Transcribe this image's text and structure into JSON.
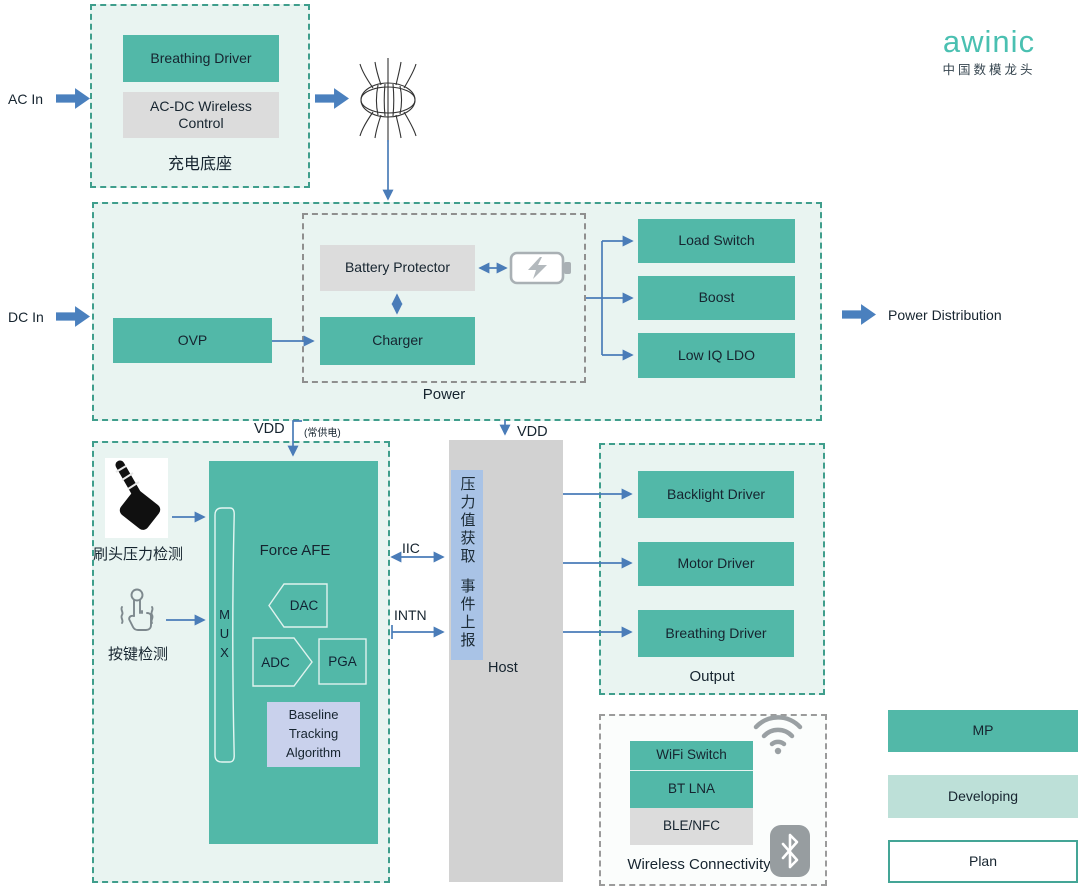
{
  "brand": {
    "logo_text": "awinic",
    "tagline": "中国数模龙头",
    "logo_color": "#4ac0b1"
  },
  "colors": {
    "block_teal": "#52b8a8",
    "block_gray": "#dcdcdc",
    "box_bg": "#e9f4f1",
    "box_border_teal": "#3f9e8c",
    "arrow_blue": "#4a7cb8",
    "fat_arrow_blue": "#4a80be",
    "host_gray": "#d2d2d2",
    "host_strip_blue": "#a9c3e6",
    "baseline_lavender": "#c9d1ec",
    "developing_teal": "#bde0d8"
  },
  "io_labels": {
    "ac_in": "AC In",
    "dc_in": "DC In",
    "power_distribution": "Power Distribution"
  },
  "signal_labels": {
    "vdd_left": "VDD",
    "vdd_left_note": "(常供电)",
    "vdd_right": "VDD",
    "iic": "IIC",
    "intn": "INTN"
  },
  "charging_dock": {
    "caption": "充电底座",
    "breathing_driver": "Breathing Driver",
    "ac_dc_wireless_control": "AC-DC Wireless Control"
  },
  "power": {
    "caption": "Power",
    "ovp": "OVP",
    "battery_protector": "Battery Protector",
    "charger": "Charger",
    "load_switch": "Load Switch",
    "boost": "Boost",
    "low_iq_ldo": "Low IQ LDO"
  },
  "sensing": {
    "brush_caption": "刷头压力检测",
    "key_caption": "按键检测",
    "force_afe": "Force AFE",
    "mux": "MUX",
    "dac": "DAC",
    "adc": "ADC",
    "pga": "PGA",
    "baseline_algorithm": "Baseline Tracking Algorithm"
  },
  "host": {
    "caption": "Host",
    "strip_line1": "压力值获取",
    "strip_line2": "事件上报"
  },
  "output_box": {
    "caption": "Output",
    "blocks": [
      "Backlight Driver",
      "Motor Driver",
      "Breathing Driver"
    ]
  },
  "wireless": {
    "caption": "Wireless Connectivity",
    "wifi_switch": "WiFi Switch",
    "bt_lna": "BT LNA",
    "ble_nfc": "BLE/NFC"
  },
  "legend": {
    "mp": "MP",
    "developing": "Developing",
    "plan": "Plan"
  }
}
